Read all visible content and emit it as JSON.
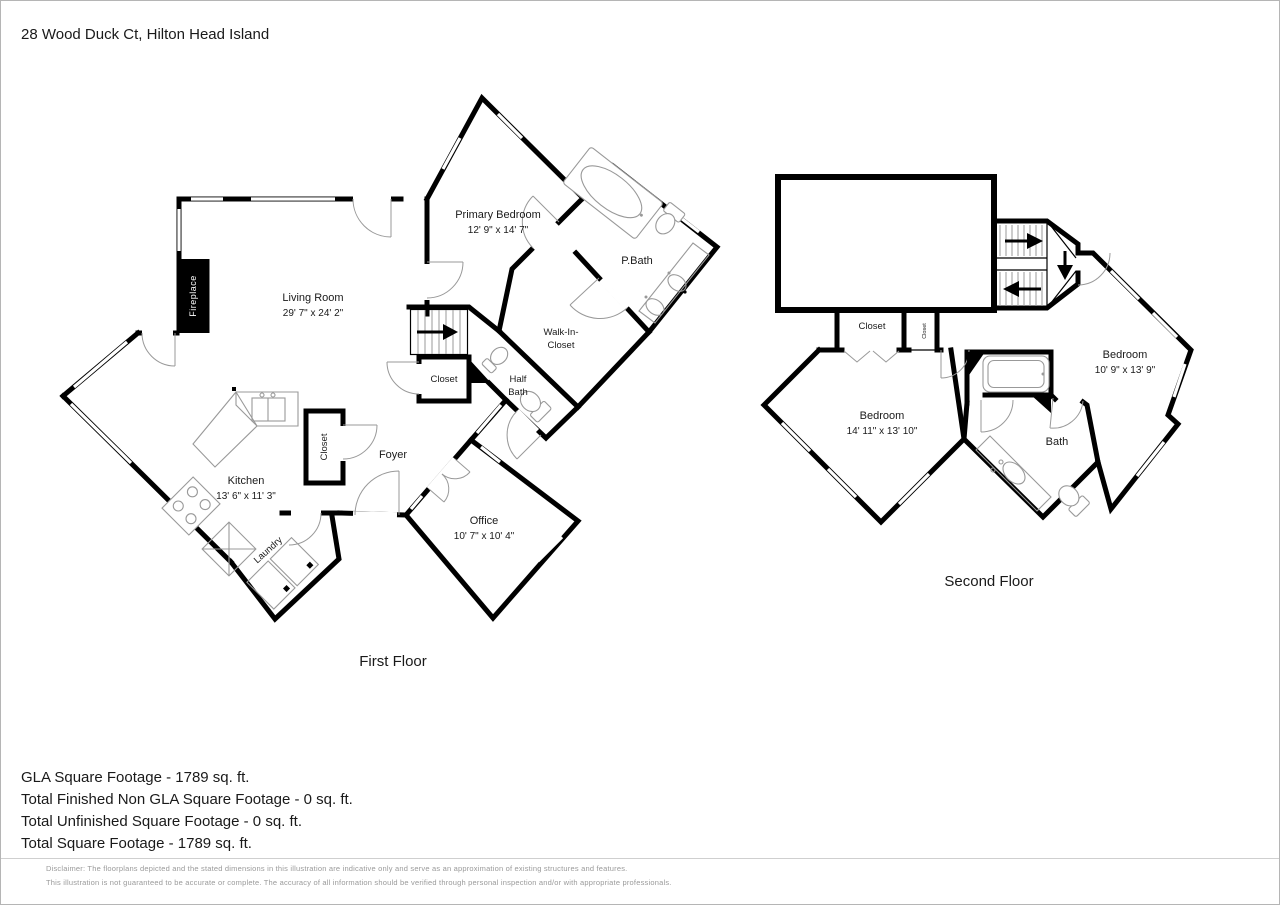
{
  "page": {
    "title": "28 Wood Duck Ct, Hilton Head Island"
  },
  "first_floor": {
    "caption": "First Floor",
    "fireplace_label": "Fireplace",
    "rooms": {
      "living_room": {
        "name": "Living Room",
        "dims": "29' 7\" x 24' 2\""
      },
      "primary_bedroom": {
        "name": "Primary Bedroom",
        "dims": "12' 9\" x 14' 7\""
      },
      "pbath": {
        "name": "P.Bath"
      },
      "walk_in_closet": {
        "line1": "Walk-In-",
        "line2": "Closet"
      },
      "closet_hall": {
        "name": "Closet"
      },
      "half_bath": {
        "line1": "Half",
        "line2": "Bath"
      },
      "foyer": {
        "name": "Foyer"
      },
      "closet_kitchen": {
        "name": "Closet"
      },
      "kitchen": {
        "name": "Kitchen",
        "dims": "13' 6\" x 11' 3\""
      },
      "laundry": {
        "name": "Laundry"
      },
      "office": {
        "name": "Office",
        "dims": "10' 7\" x 10' 4\""
      }
    }
  },
  "second_floor": {
    "caption": "Second Floor",
    "rooms": {
      "closet_large": {
        "name": "Closet"
      },
      "closet_small": {
        "name": "Closet"
      },
      "bedroom_left": {
        "name": "Bedroom",
        "dims": "14' 11\" x 13' 10\""
      },
      "bedroom_right": {
        "name": "Bedroom",
        "dims": "10' 9\" x 13' 9\""
      },
      "bath": {
        "name": "Bath"
      }
    }
  },
  "summary": {
    "gla": "GLA Square Footage - 1789 sq. ft.",
    "non_gla": "Total Finished Non GLA Square Footage - 0 sq. ft.",
    "unfinished": "Total Unfinished Square Footage - 0 sq. ft.",
    "total": "Total Square Footage - 1789 sq. ft."
  },
  "disclaimer": {
    "line1": "Disclaimer: The floorplans depicted and the stated dimensions in this illustration are indicative only and serve as an approximation of existing structures and features.",
    "line2": "This illustration is not guaranteed to be accurate or complete. The accuracy of all information should be verified through personal inspection and/or with appropriate professionals."
  },
  "colors": {
    "wall": "#000000",
    "fixture_line": "#999999",
    "disclaimer_text": "#9a9a9a"
  }
}
